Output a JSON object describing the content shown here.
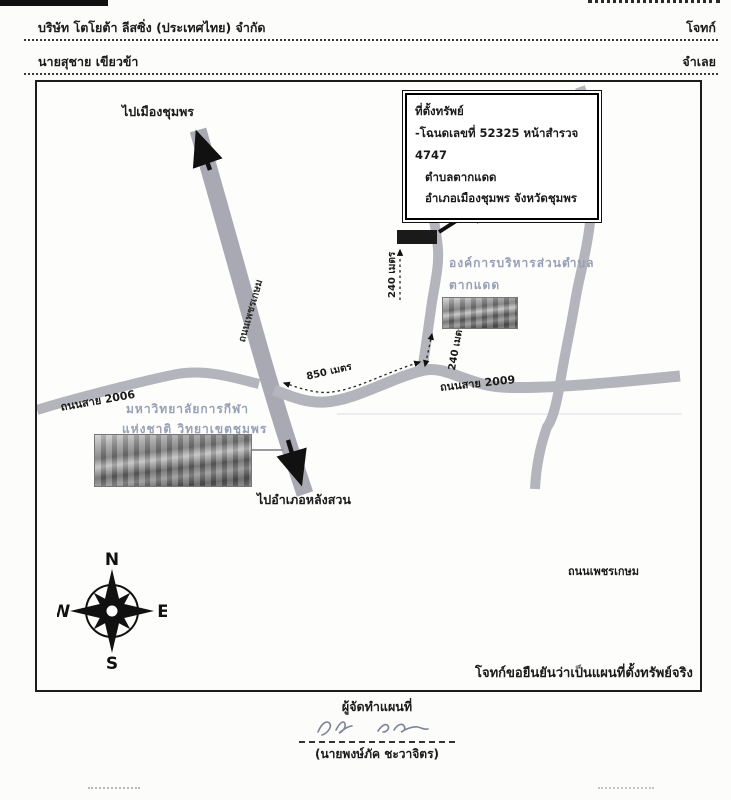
{
  "page": {
    "header": {
      "plaintiff_name": "บริษัท โตโยต้า ลีสซิ่ง (ประเทศไทย) จำกัด",
      "plaintiff_role": "โจทก์",
      "defendant_name": "นายสุชาย เขียวข้า",
      "defendant_role": "จำเลย"
    },
    "map": {
      "info_box": {
        "title": "ที่ตั้งทรัพย์",
        "deed_line": "-โฉนดเลขที่  52325    หน้าสำรวจ  4747",
        "subdistrict": "ตำบลตากแดด",
        "district_province": "อำเภอเมืองชุมพร  จังหวัดชุมพร"
      },
      "labels": {
        "to_chumphon": "ไปเมืองชุมพร",
        "to_langsuan": "ไปอำเภอหลังสวน",
        "highway_name": "ถนนเพชรเกษม",
        "road_2006": "ถนนสาย 2006",
        "road_2009": "ถนนสาย 2009",
        "phetkasem_text": "ถนนเพชรเกษม",
        "distance_850": "850 เมตร",
        "distance_240_a": "240 เมตร",
        "distance_240_b": "240 เมตร",
        "sao_line1": "องค์การบริหารส่วนตำบล",
        "sao_line2": "ตากแดด",
        "university_line1": "มหาวิทยาลัยการกีฬา",
        "university_line2": "แห่งชาติ วิทยาเขตชุมพร",
        "confirmation": "โจทก์ขอยืนยันว่าเป็นแผนที่ตั้งทรัพย์จริง"
      },
      "compass": {
        "n": "N",
        "e": "E",
        "s": "S",
        "w": "W"
      }
    },
    "footer": {
      "preparer_label": "ผู้จัดทำแผนที่",
      "preparer_name": "(นายพงษ์ภัค ชะวาจิตร)"
    },
    "colors": {
      "road": "#b4b4bc",
      "highway": "#a9a9b3",
      "ink": "#1a1a1a",
      "faded_label": "#98a0b6"
    }
  }
}
